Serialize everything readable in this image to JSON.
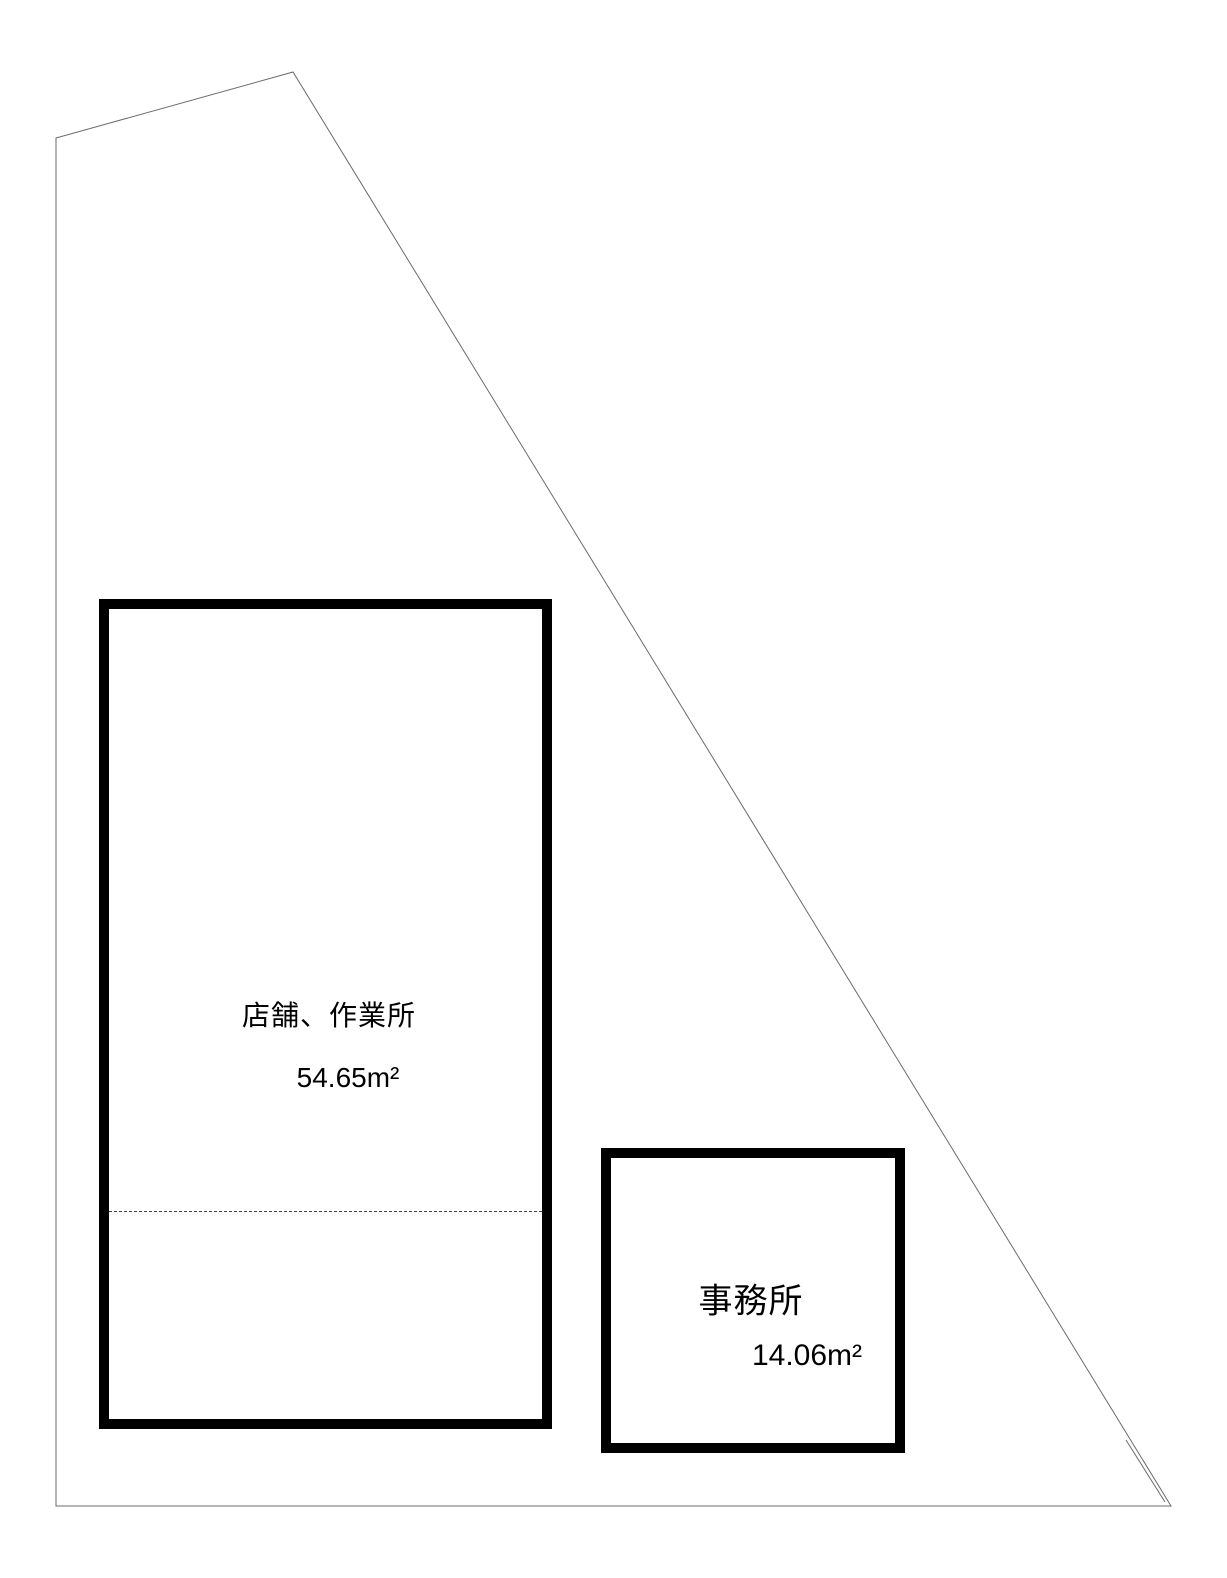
{
  "plan": {
    "buildings": [
      {
        "label": "店舗、作業所",
        "area": "54.65m²"
      },
      {
        "label": "事務所",
        "area": "14.06m²"
      }
    ]
  },
  "colors": {
    "background": "#ffffff",
    "boundary": "#6b6b6b",
    "building": "#000000",
    "partition": "#444444"
  }
}
